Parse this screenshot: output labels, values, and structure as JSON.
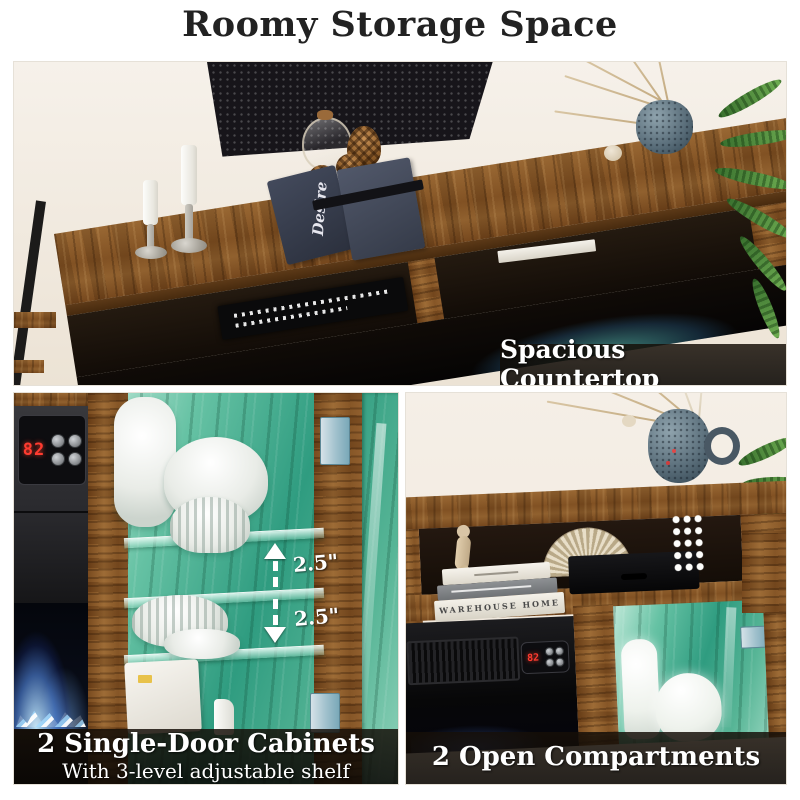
{
  "title": "Roomy Storage Space",
  "colors": {
    "led_accent": "#2fa487",
    "flame_blue": "#4b7fe0",
    "thermostat_red": "#ff3b30",
    "wood_brown": "#8a5a2e",
    "overlay_dark": "#140e08",
    "background": "#ffffff"
  },
  "panels": {
    "countertop": {
      "label": "Spacious Countertop",
      "book_spine": "Desire"
    },
    "cabinets": {
      "caption": "2 Single-Door Cabinets",
      "subcaption": "With 3-level adjustable shelf",
      "shelf_gap_upper": "2.5\"",
      "shelf_gap_lower": "2.5\"",
      "thermostat": "82"
    },
    "compartments": {
      "caption": "2 Open Compartments",
      "thermostat": "82",
      "book_spine": "WAREHOUSE HOME"
    }
  }
}
